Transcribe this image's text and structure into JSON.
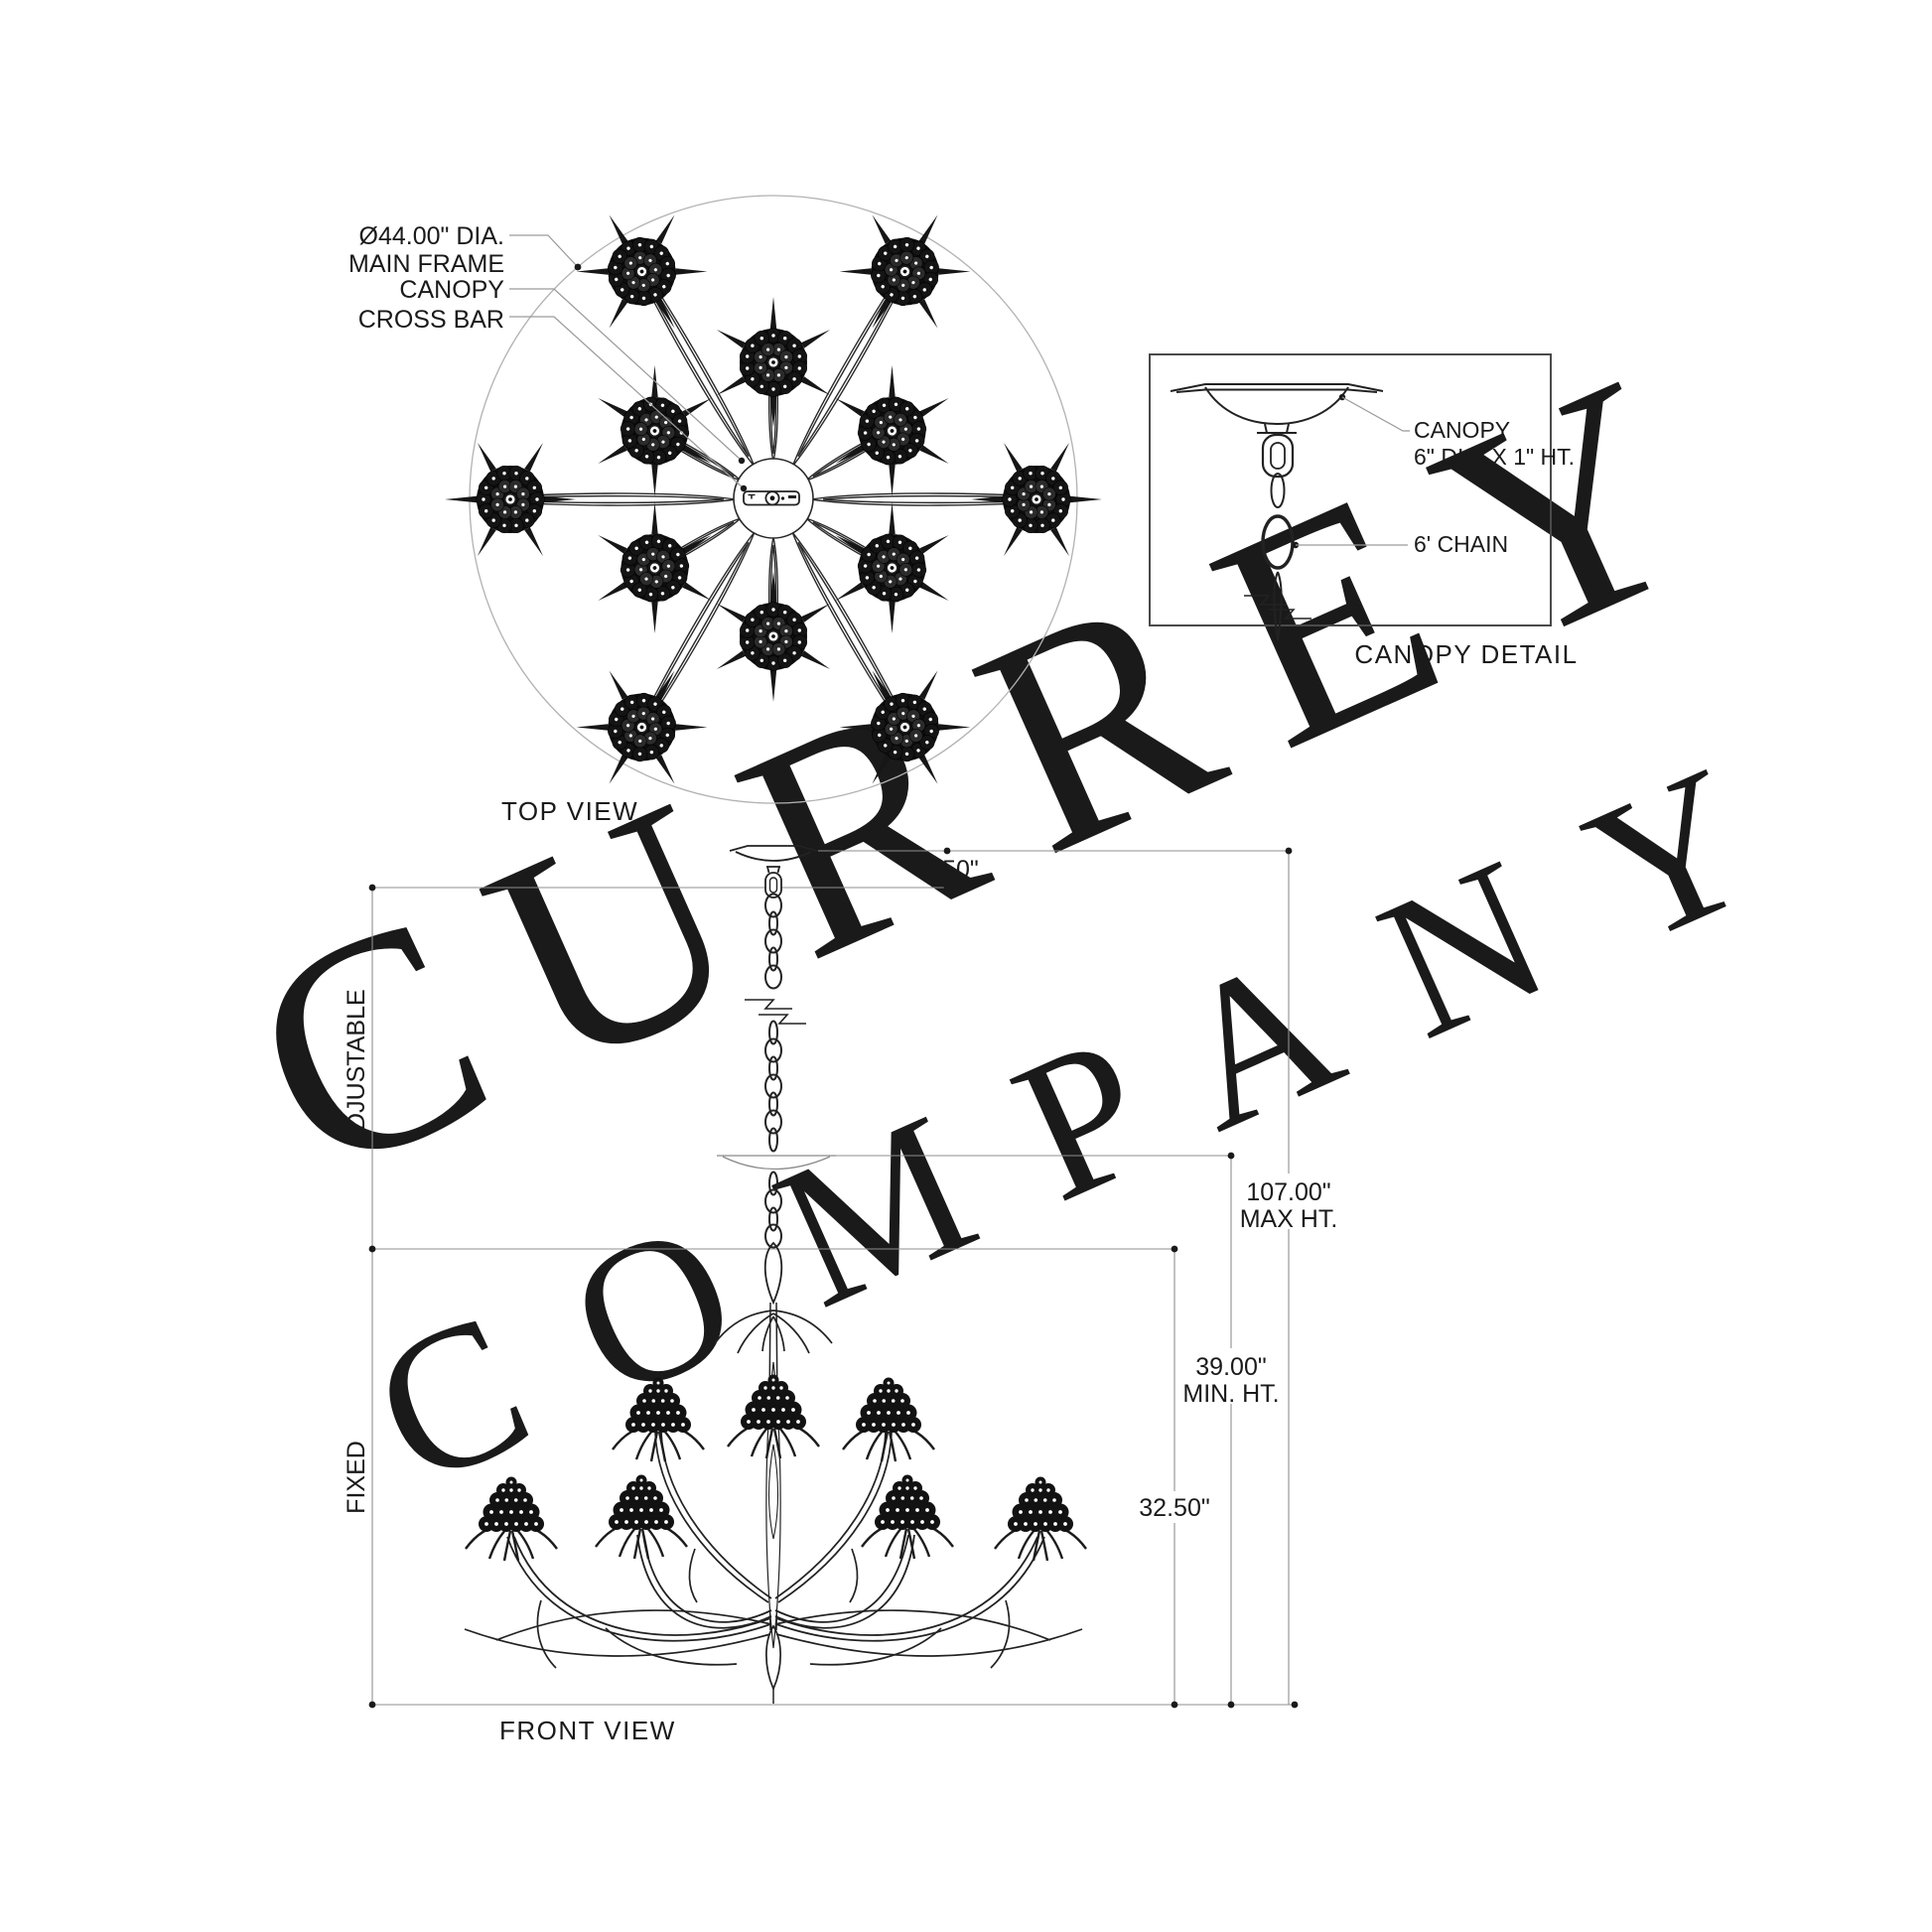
{
  "colors": {
    "ink": "#222222",
    "dim_lines": "#8f8f8f",
    "watermark": "#ececec",
    "background": "#ffffff"
  },
  "watermark": {
    "line1": "CURREY",
    "line2": "COMPANY"
  },
  "top_view": {
    "caption": "TOP VIEW",
    "label_main_frame_line1": "Ø44.00\" DIA.",
    "label_main_frame_line2": "MAIN FRAME",
    "label_canopy": "CANOPY",
    "label_cross_bar": "CROSS BAR"
  },
  "canopy_detail": {
    "caption": "CANOPY DETAIL",
    "label_canopy_line1": "CANOPY",
    "label_canopy_line2": "6\" DIA. X 1\" HT.",
    "label_chain": "6' CHAIN"
  },
  "front_view": {
    "caption": "FRONT VIEW",
    "dim_canopy_height": "2.50\"",
    "dim_max_height_line1": "107.00\"",
    "dim_max_height_line2": "MAX HT.",
    "dim_min_height_line1": "39.00\"",
    "dim_min_height_line2": "MIN. HT.",
    "dim_fixed_body": "32.50\"",
    "label_adjustable": "ADJUSTABLE",
    "label_fixed": "FIXED"
  }
}
